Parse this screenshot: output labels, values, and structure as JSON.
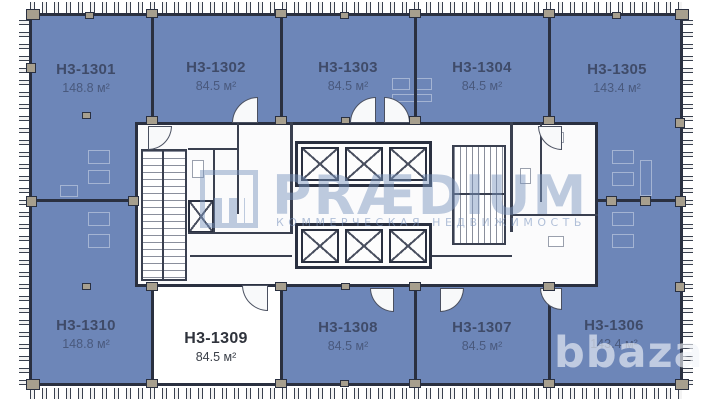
{
  "plan_title": "Office floor plan H3-13xx",
  "units": [
    {
      "id": "H3-1301",
      "area": "148.8 м²"
    },
    {
      "id": "H3-1302",
      "area": "84.5 м²"
    },
    {
      "id": "H3-1303",
      "area": "84.5 м²"
    },
    {
      "id": "H3-1304",
      "area": "84.5 м²"
    },
    {
      "id": "H3-1305",
      "area": "143.4 м²"
    },
    {
      "id": "H3-1306",
      "area": "143.4 м²"
    },
    {
      "id": "H3-1307",
      "area": "84.5 м²"
    },
    {
      "id": "H3-1308",
      "area": "84.5 м²"
    },
    {
      "id": "H3-1309",
      "area": "84.5 м²"
    },
    {
      "id": "H3-1310",
      "area": "148.8 м²"
    }
  ],
  "watermarks": {
    "brand": "PRÆDIUM",
    "tagline": "КОММЕРЧЕСКАЯ НЕДВИЖИМОСТЬ",
    "site": "bbaza"
  },
  "colors": {
    "unit_fill": "#6d86b8",
    "wall": "#2a3040",
    "column": "#a79f8e",
    "brand_watermark": "#7a94be",
    "site_watermark": "#f0f4f9"
  }
}
